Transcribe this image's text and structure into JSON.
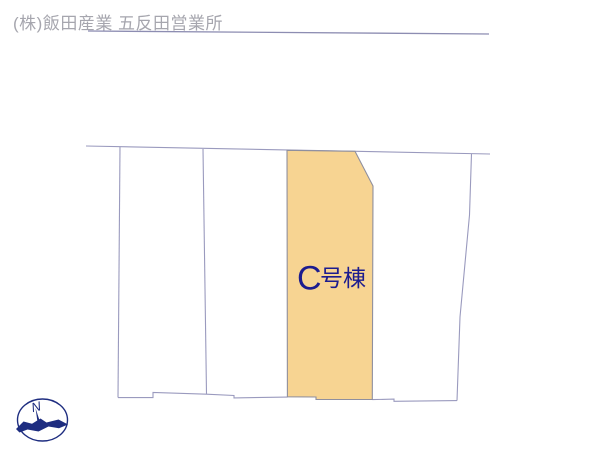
{
  "window": {
    "width_px": 600,
    "height_px": 450,
    "background_color": "#ffffff"
  },
  "header": {
    "company_label": "(株)飯田産業 五反田営業所",
    "text_color": "#a6a6ae"
  },
  "site_plan": {
    "boundary_line_color": "#9a9abe",
    "top_boundary_line_color": "#8d8db2",
    "lot_count_outlined": 4,
    "lots": {
      "highlighted_lot": {
        "label": "C号棟",
        "label_letter": "C",
        "label_suffix": "号棟",
        "fill_color": "#f7d492",
        "outline_color": "#8f8f9e",
        "label_color": "#1c1c8f"
      }
    },
    "compass": {
      "north_label": "N",
      "color": "#1e2d80"
    }
  }
}
